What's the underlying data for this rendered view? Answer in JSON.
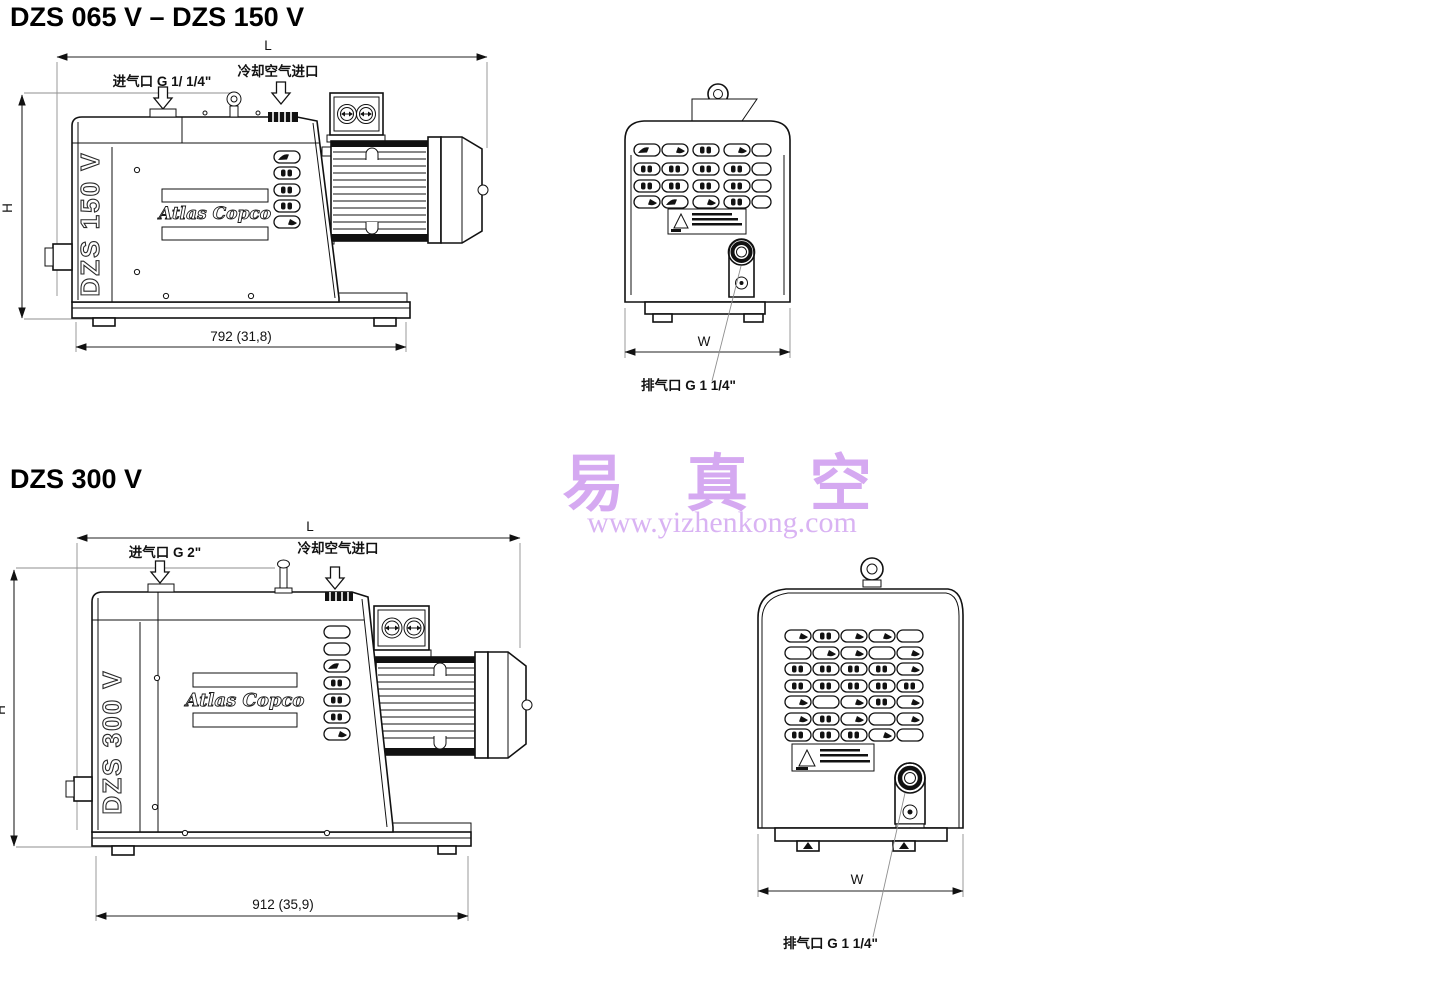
{
  "page": {
    "background": "#ffffff",
    "ink": "#111111",
    "watermark_color": "#d5a9f1"
  },
  "watermark": {
    "brand": "易 真 空",
    "url": "www.yizhenkong.com"
  },
  "shared": {
    "logo": "Atlas Copco",
    "dim_length": "L",
    "dim_height": "H",
    "dim_width": "W"
  },
  "section1": {
    "title": "DZS 065 V – DZS 150 V",
    "model": "DZS 150 V",
    "inlet_label": "进气口 G 1/ 1/4\"",
    "cooling_label": "冷却空气进口",
    "exhaust_label": "排气口 G 1 1/4\"",
    "base_length": "792 (31,8)"
  },
  "section2": {
    "title": "DZS 300 V",
    "model": "DZS 300 V",
    "inlet_label": "进气口 G 2\"",
    "cooling_label": "冷却空气进口",
    "exhaust_label": "排气口 G 1 1/4\"",
    "base_length": "912 (35,9)"
  }
}
